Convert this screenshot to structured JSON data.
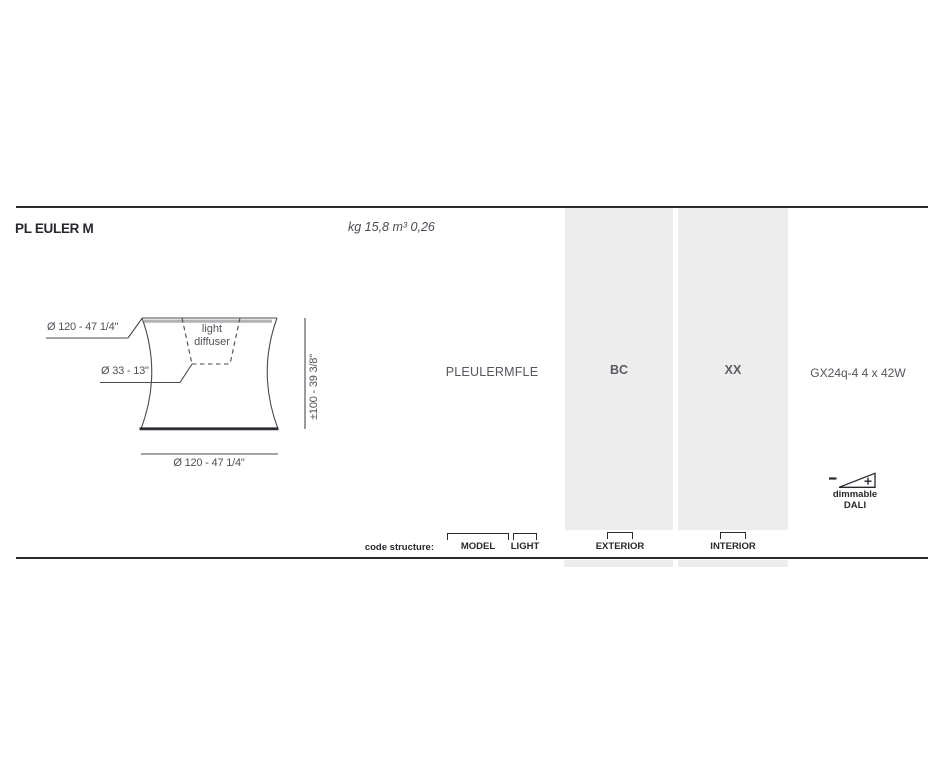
{
  "page": {
    "title": "PL EULER M",
    "weight_volume": "kg 15,8 m³ 0,26"
  },
  "drawing": {
    "top_diameter": "Ø 120 - 47 1/4\"",
    "inner_diameter": "Ø 33 - 13\"",
    "height": "±100 - 39 3/8\"",
    "bottom_diameter": "Ø 120 - 47 1/4\"",
    "diffuser_line1": "light",
    "diffuser_line2": "diffuser"
  },
  "spec": {
    "model_code": "PLEULERMFLE",
    "exterior_code": "BC",
    "interior_code": "XX",
    "lamp": "GX24q-4 4 x 42W",
    "dimmable_line1": "dimmable",
    "dimmable_line2": "DALI"
  },
  "code_structure": {
    "label": "code structure:",
    "brackets": [
      {
        "label": "MODEL"
      },
      {
        "label": "LIGHT"
      },
      {
        "label": "EXTERIOR"
      },
      {
        "label": "INTERIOR"
      }
    ]
  },
  "colors": {
    "ink": "#2a2930",
    "dim_text": "#504f57",
    "column_gray": "#ededee",
    "band_gray": "#b3b3b7"
  }
}
